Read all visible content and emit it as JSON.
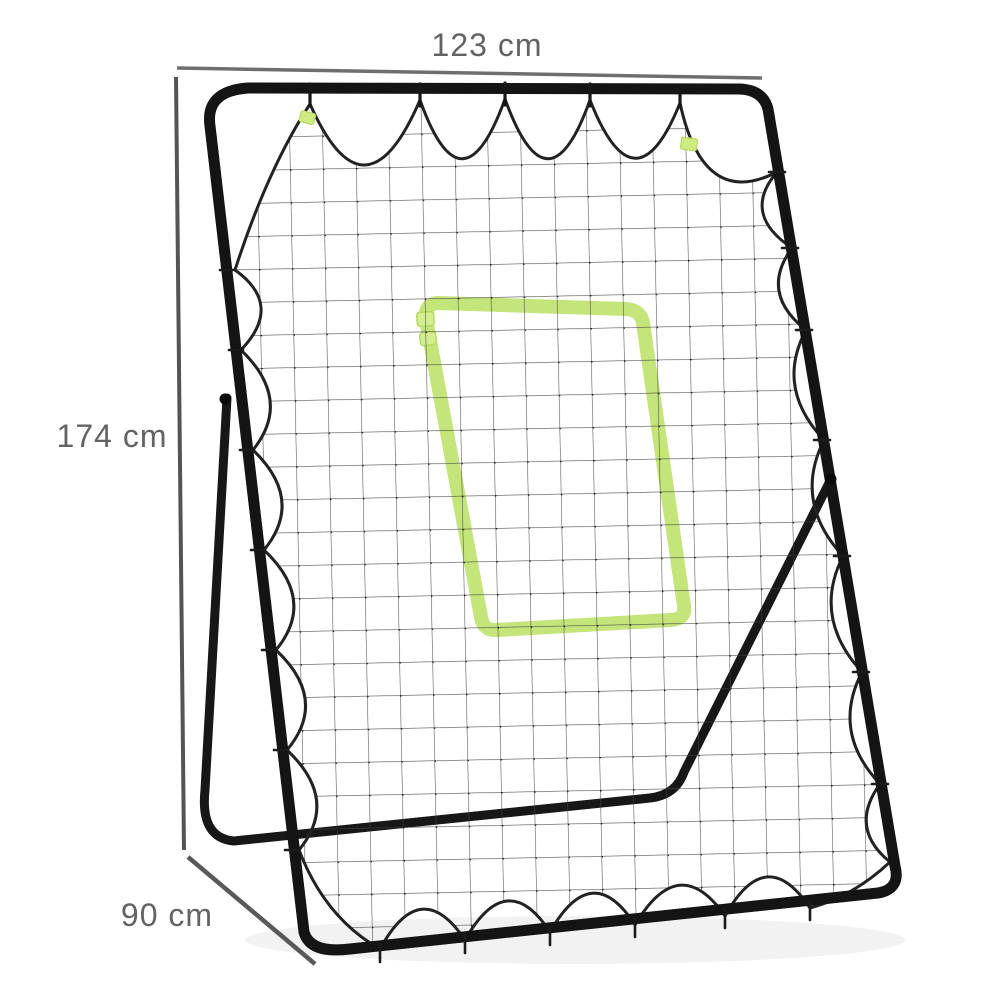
{
  "page": {
    "background": "#ffffff"
  },
  "diagram": {
    "subject": "Rebounder pitchback net with tubular steel A-frame, bungee-tied mesh net and green target zone",
    "dimension_labels": {
      "width": "123 cm",
      "height": "174 cm",
      "depth": "90 cm"
    },
    "colors": {
      "frame_black": "#141414",
      "net_line_gray": "#454545",
      "net_cord_black": "#222222",
      "target_green": "#c1e473",
      "annotation_line_gray": "#666666",
      "annotation_text_gray": "#636363"
    }
  }
}
